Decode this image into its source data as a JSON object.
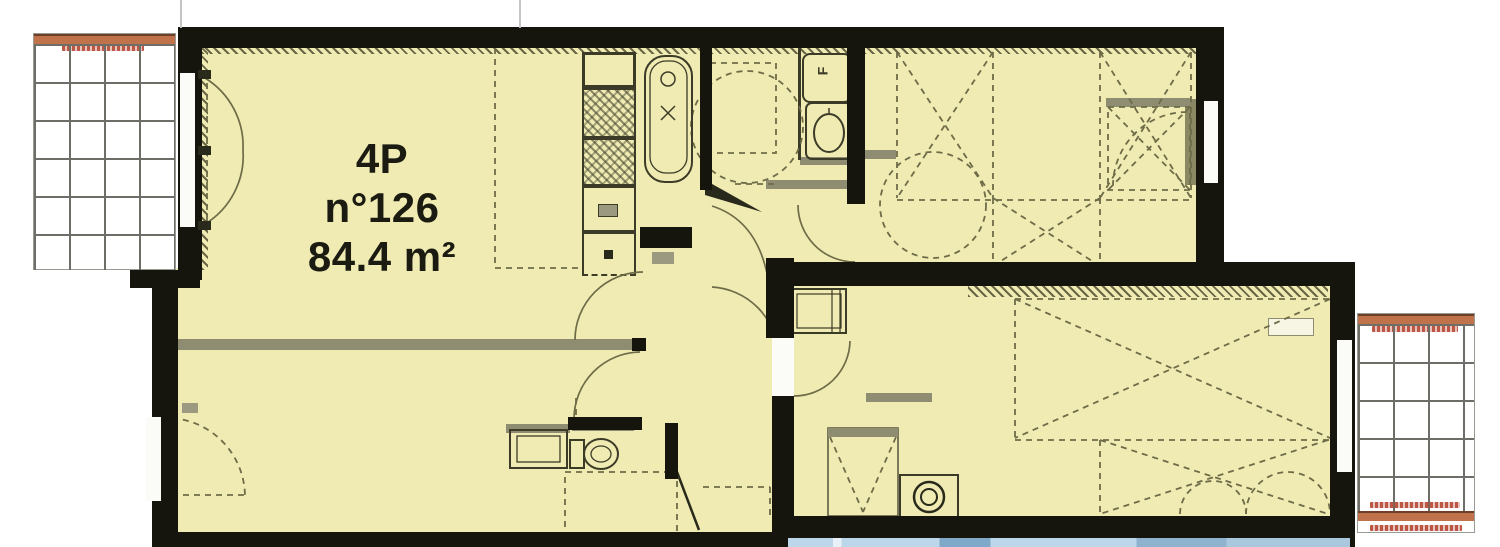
{
  "plan": {
    "unit": {
      "type_label": "4P",
      "number_label": "n°126",
      "area_label": "84.4 m²"
    },
    "closet_label": "F"
  },
  "colors": {
    "room_fill": "#EFEBB2",
    "wall": "#15150D",
    "partition_gray": "#8E8D72",
    "line_olive": "#6E6C48",
    "balcony_bar_orange": "#C0734A",
    "balcony_text_red": "#B5442F",
    "water_blue": "#BCD7EA",
    "background": "#FFFFFF"
  },
  "fixtures": [
    "bathtub",
    "washbasin",
    "toilet",
    "kitchen-counter",
    "hob",
    "sink",
    "water-heater",
    "wardrobe-cross",
    "turning-circle",
    "door-swing",
    "window",
    "balcony-grating"
  ]
}
